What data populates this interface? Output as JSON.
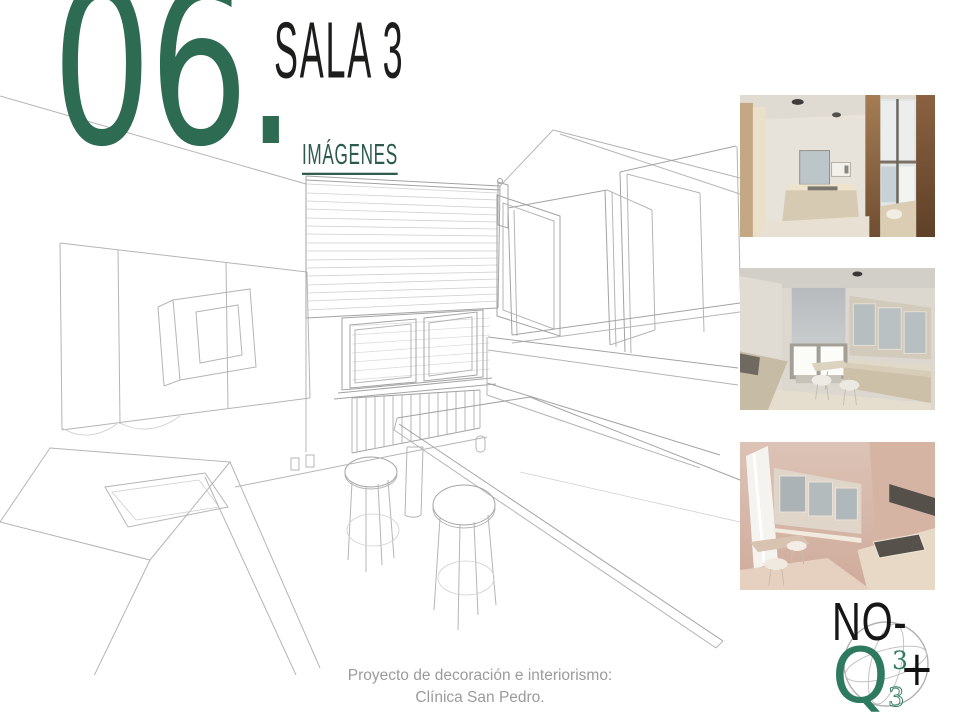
{
  "slide": {
    "section_number": "06.",
    "title": "SALA 3",
    "subtitle": "IMÁGENES",
    "footer_line1": "Proyecto de decoración e interiorismo:",
    "footer_line2": "Clínica San Pedro.",
    "colors": {
      "accent_green": "#2e6b53",
      "subtitle_green": "#2c5a4c",
      "title_color": "#1d1d1b",
      "footer_gray": "#9b9b9b",
      "sketch_line_gray": "#b5b5b5"
    }
  },
  "sketch": {
    "label": "perspective line drawing of room: roller blind, window, radiator, cabinets, microwave, sink counter, table, two stools, bench"
  },
  "thumbnails": [
    {
      "id": "render-1",
      "alt": "3D render: kitchenette with counter, mirror and microwave"
    },
    {
      "id": "render-2",
      "alt": "3D render: corner bench with window, cabinets, table and stools"
    },
    {
      "id": "render-3",
      "alt": "3D render: cabinets, table and stools in warm light"
    }
  ],
  "logo": {
    "top_text": "NO-",
    "q": "Q",
    "plus": "+",
    "three_upper": "3",
    "three_lower": "3"
  }
}
